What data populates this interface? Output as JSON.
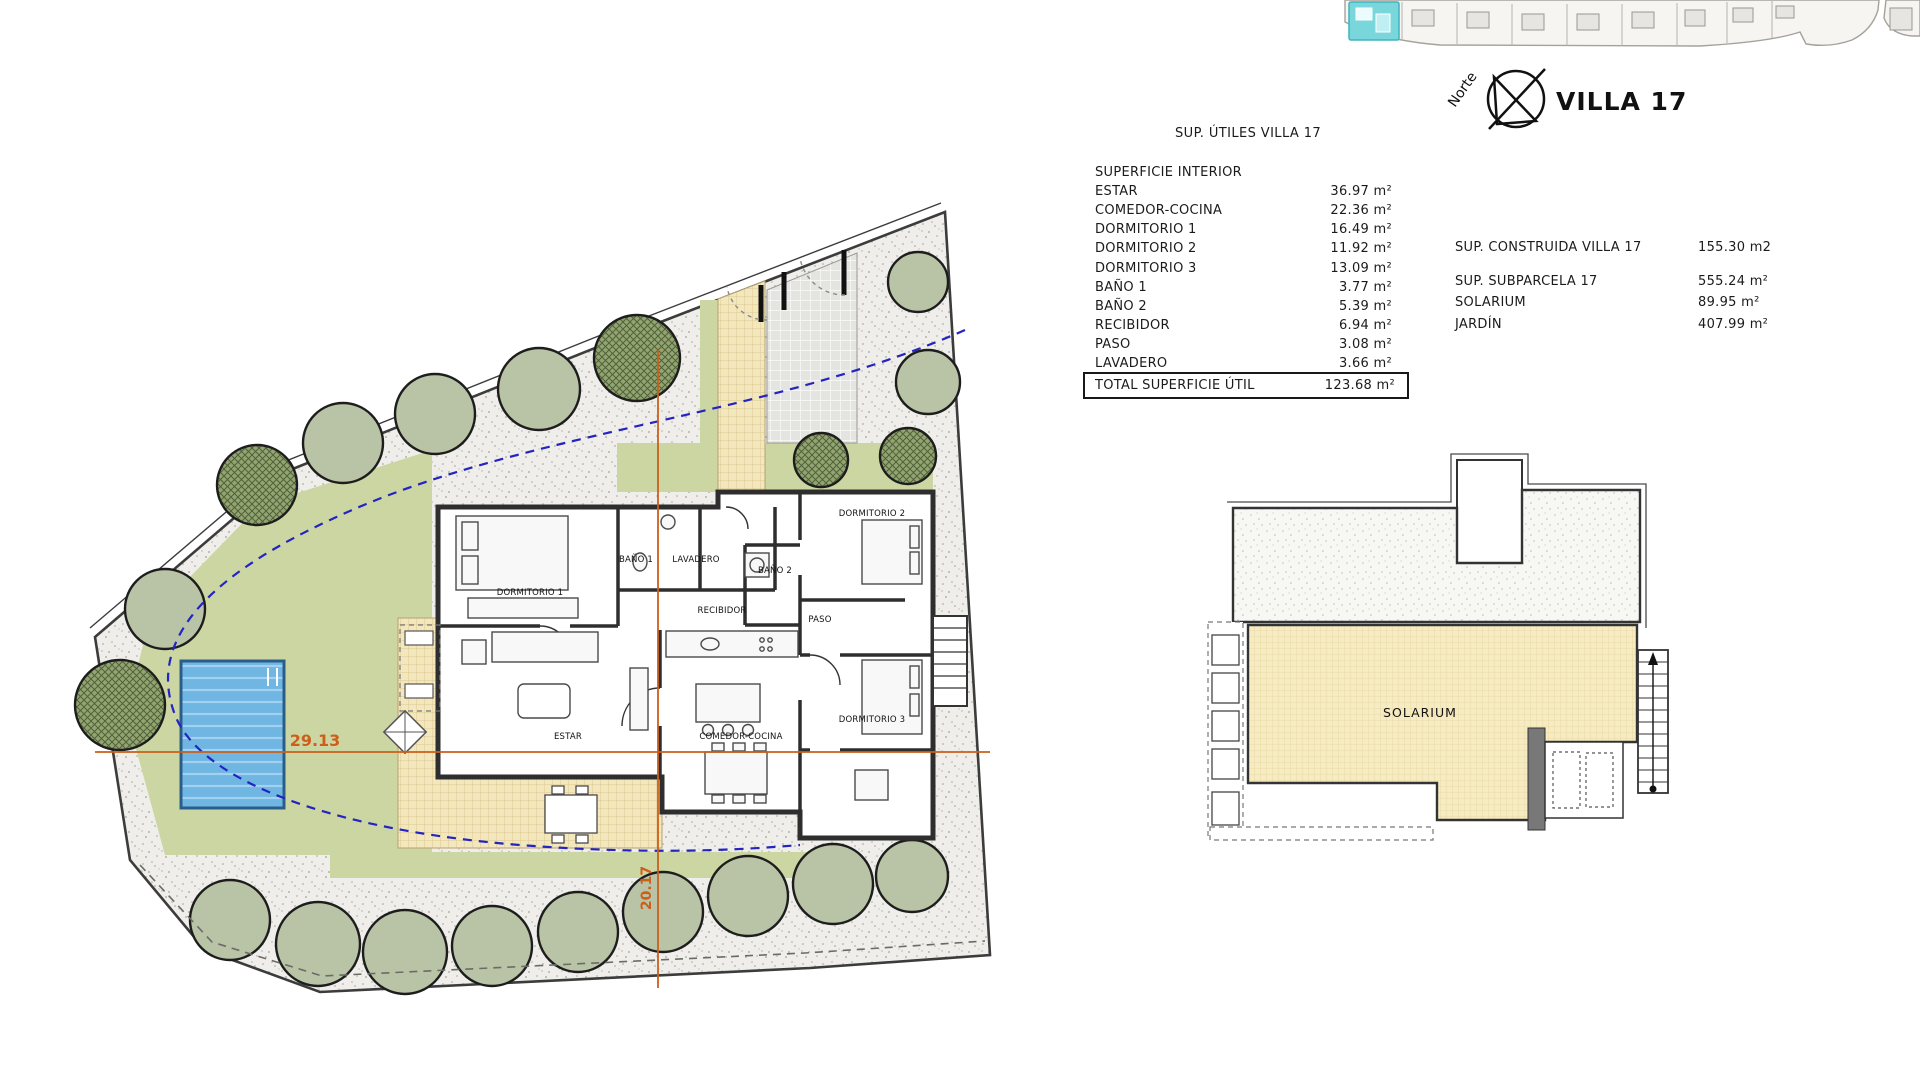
{
  "header": {
    "villa_title": "VILLA 17",
    "north_label": "Norte"
  },
  "areas_table": {
    "title": "SUP. ÚTILES VILLA 17",
    "section_header": "SUPERFICIE INTERIOR",
    "rows": [
      {
        "label": "ESTAR",
        "value": "36.97 m²"
      },
      {
        "label": "COMEDOR-COCINA",
        "value": "22.36 m²"
      },
      {
        "label": "DORMITORIO 1",
        "value": "16.49 m²"
      },
      {
        "label": "DORMITORIO 2",
        "value": "11.92 m²"
      },
      {
        "label": "DORMITORIO 3",
        "value": "13.09 m²"
      },
      {
        "label": "BAÑO 1",
        "value": "3.77 m²"
      },
      {
        "label": "BAÑO 2",
        "value": "5.39 m²"
      },
      {
        "label": "RECIBIDOR",
        "value": "6.94 m²"
      },
      {
        "label": "PASO",
        "value": "3.08 m²"
      },
      {
        "label": "LAVADERO",
        "value": "3.66 m²"
      }
    ],
    "total_label": "TOTAL SUPERFICIE ÚTIL",
    "total_value": "123.68 m²"
  },
  "summary_table": {
    "rows": [
      {
        "label": "SUP. CONSTRUIDA VILLA 17",
        "value": "155.30 m2"
      },
      {
        "label": "SUP. SUBPARCELA 17",
        "value": "555.24 m²"
      },
      {
        "label": "SOLARIUM",
        "value": "89.95 m²"
      },
      {
        "label": "JARDÍN",
        "value": "407.99 m²"
      }
    ]
  },
  "floor_plan": {
    "rooms": {
      "dormitorio1": "DORMITORIO 1",
      "bano1": "BAÑO 1",
      "lavadero": "LAVADERO",
      "recibidor": "RECIBIDOR",
      "estar": "ESTAR",
      "comedor_cocina": "COMEDOR-COCINA",
      "dormitorio2": "DORMITORIO 2",
      "bano2": "BAÑO 2",
      "paso": "PASO",
      "dormitorio3": "DORMITORIO 3"
    },
    "dimensions": {
      "width_m": "29.13",
      "depth_m": "20.17"
    }
  },
  "roof_plan": {
    "label": "SOLARIUM"
  },
  "colors": {
    "garden_green": "#ccd6a3",
    "pool_blue": "#63aede",
    "tile_cream": "#f3e7bd",
    "dimension_orange": "#cc5f1a",
    "setback_blue": "#2424c0",
    "highlight_cyan": "#79d7dc"
  }
}
